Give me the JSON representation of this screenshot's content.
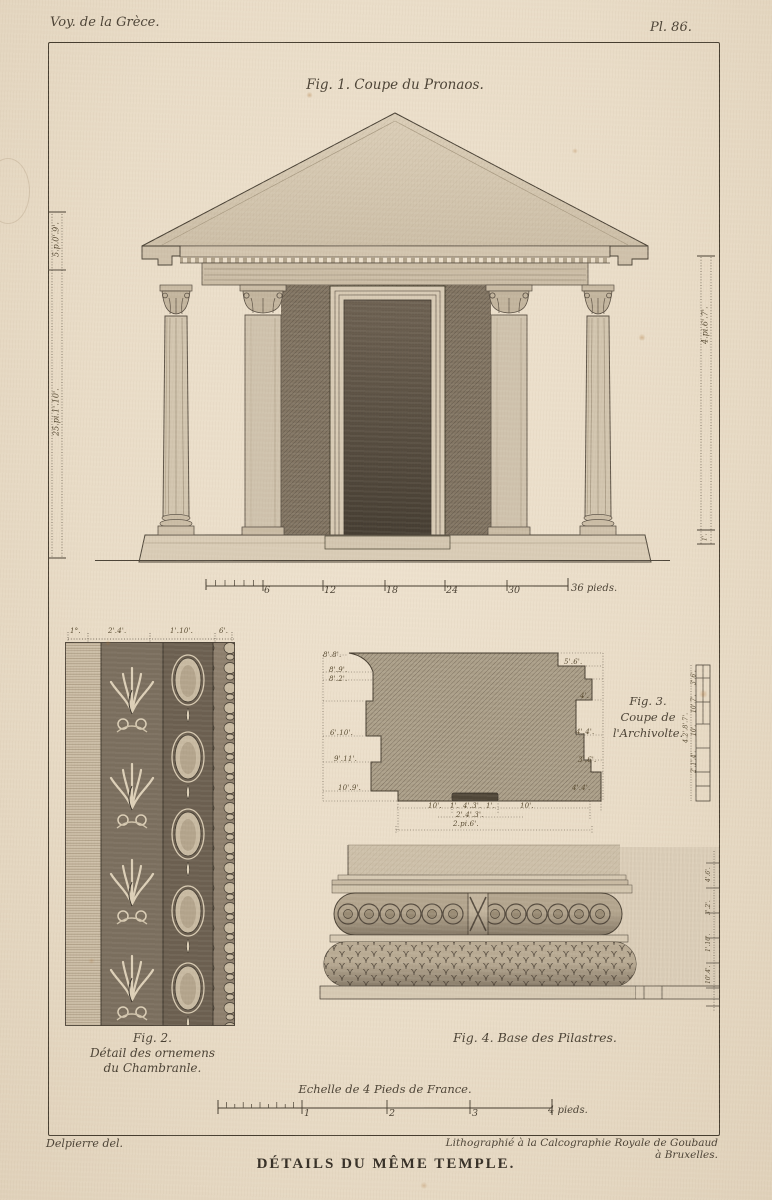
{
  "plate": {
    "series_title": "Voy. de la Grèce.",
    "plate_number": "Pl. 86."
  },
  "fig1": {
    "caption": "Fig. 1. Coupe du Pronaos.",
    "left_dim_upper": "5.p.0'.9'.",
    "left_dim_lower": "25.pi.1'.10'.",
    "right_dim": "4.pi.6'.7'.",
    "right_dim_small": "1'.",
    "scale": {
      "tick_labels": [
        "6",
        "12",
        "18",
        "24",
        "30"
      ],
      "end_label": "36 pieds."
    }
  },
  "fig2": {
    "caption": [
      "Fig. 2.",
      "Détail des ornemens",
      "du Chambranle."
    ],
    "top_dims": [
      "1°.",
      "2'.4'.",
      "1'.10'.",
      "6'."
    ]
  },
  "fig3": {
    "caption": [
      "Fig. 3.",
      "Coupe de",
      "l'Archivolte."
    ],
    "left_dims": [
      "8'.8'.",
      "8'.9'.",
      "8'.2'.",
      "6'.10'.",
      "9'.11'.",
      "10'.9'."
    ],
    "right_dims": [
      "5'.6'.",
      "4'.",
      "4'.4'.",
      "3'.6'.",
      "4'.4'."
    ],
    "bottom_dims": [
      "10'.",
      "1'.",
      "4'.3'.",
      "1'.",
      "10'."
    ],
    "bottom_dims2": "2'.4'.3'.",
    "bottom_total": "2.pi.6'.",
    "ruler_dims": [
      "3'.6'.",
      "10'.7'.",
      "10'.",
      "2'.1'.4'."
    ],
    "ruler_total": "4.2'.8'.7'."
  },
  "fig4": {
    "caption": "Fig. 4. Base des Pilastres.",
    "right_dims": [
      "4'.6'.",
      "3'.2'.",
      "1'.10'.",
      "10'.4'."
    ]
  },
  "scale_bottom": {
    "title": "Echelle de 4 Pieds de France.",
    "tick_labels": [
      "1",
      "2",
      "3"
    ],
    "end_label": "4 pieds."
  },
  "footer": {
    "credit_left": "Delpierre del.",
    "credit_right": "Lithographié à la Calcographie Royale de Goubaud à Bruxelles.",
    "main_title": "DÉTAILS DU MÊME TEMPLE."
  },
  "colors": {
    "paper": "#e9dcc7",
    "ink": "#3a322a",
    "drawing_light": "#d6c9b3",
    "drawing_mid": "#9a8d7a",
    "drawing_dark": "#5d5347",
    "door_dark": "#564d41"
  }
}
